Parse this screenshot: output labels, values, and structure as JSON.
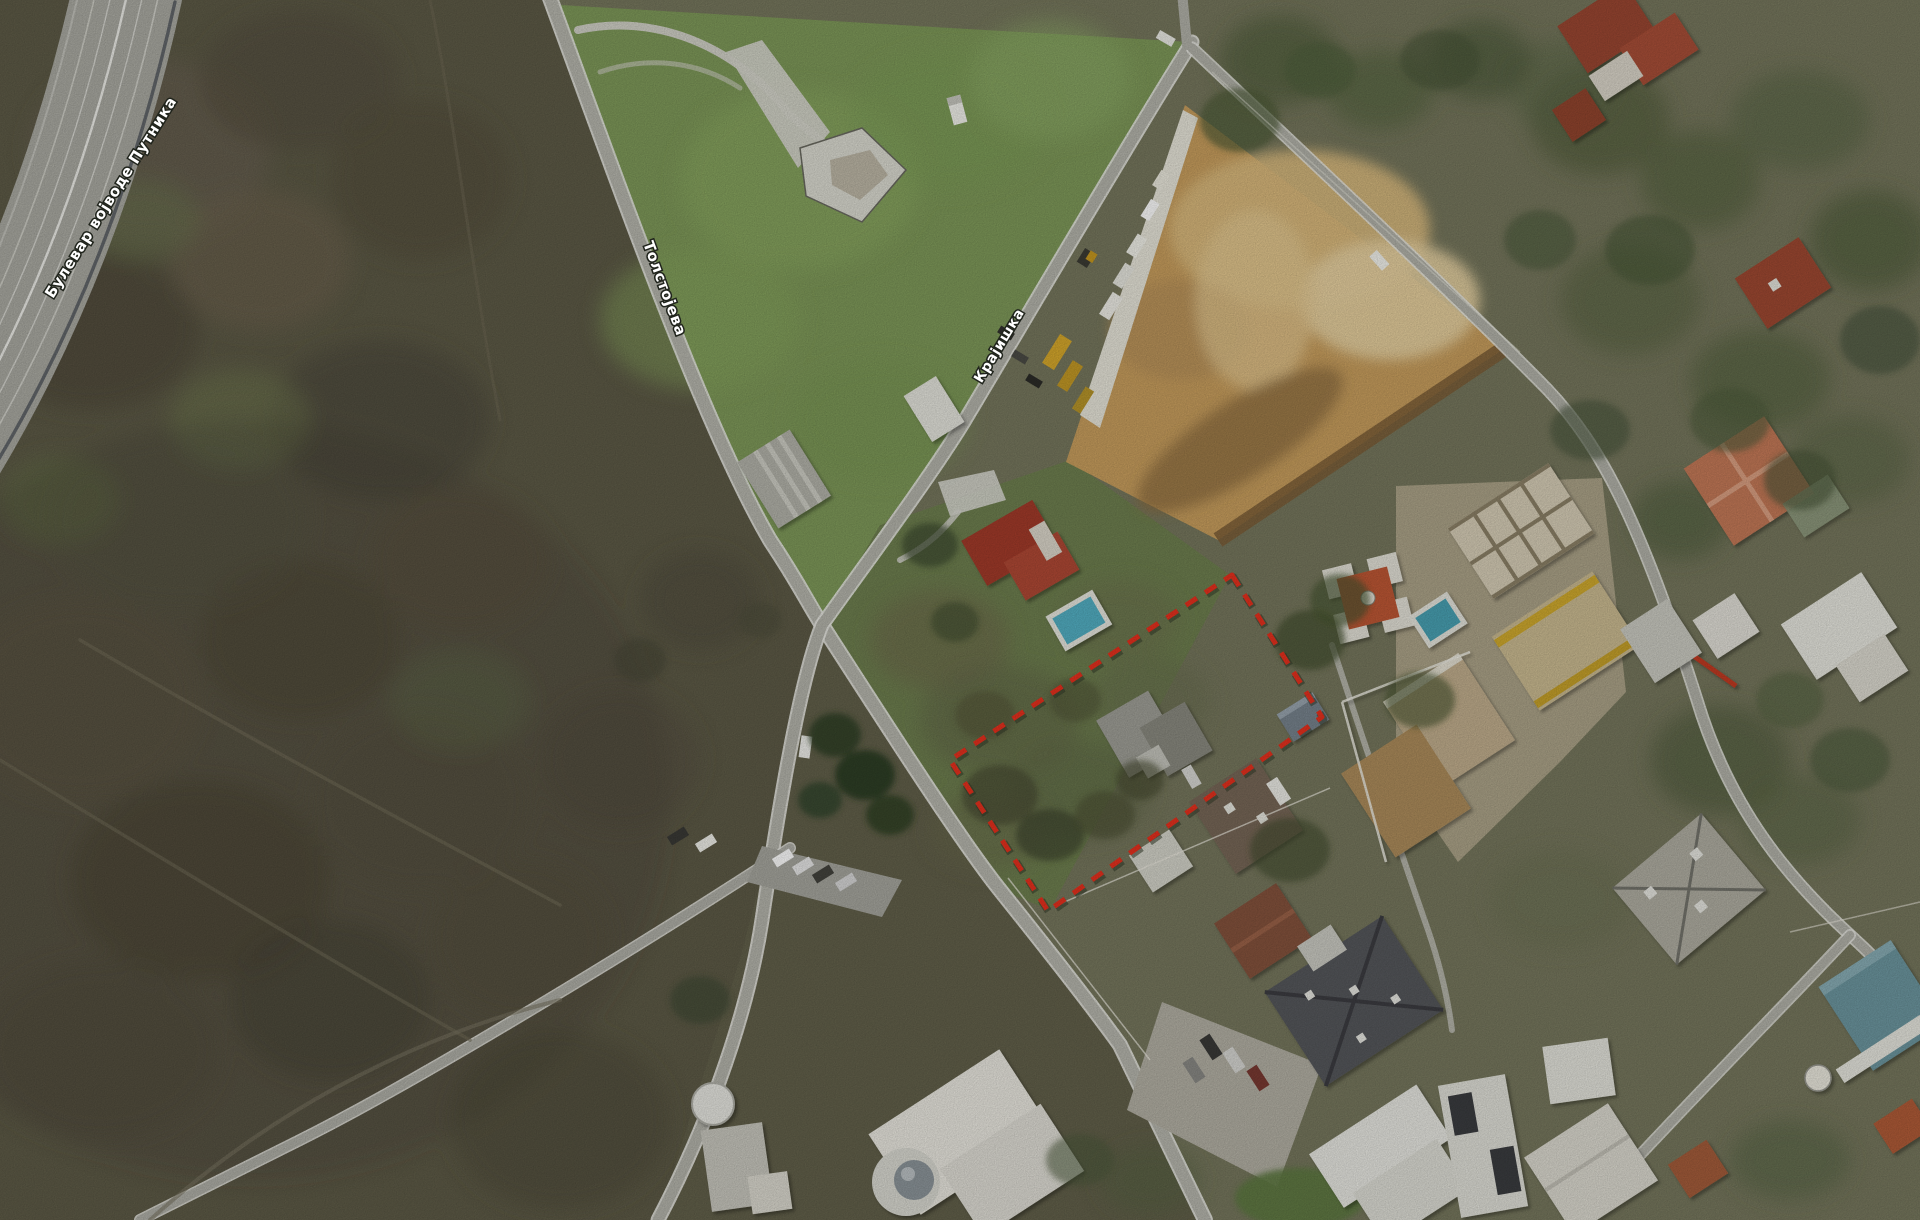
{
  "map": {
    "view_type": "satellite-aerial",
    "street_labels": [
      {
        "id": "bulevar",
        "name": "Булевар војводе Путника"
      },
      {
        "id": "tolstojeva",
        "name": "Толстојева"
      },
      {
        "id": "krajiska",
        "name": "Крајишка"
      }
    ],
    "parcel_outline": {
      "color": "#e8311e",
      "style": "dashed"
    }
  }
}
